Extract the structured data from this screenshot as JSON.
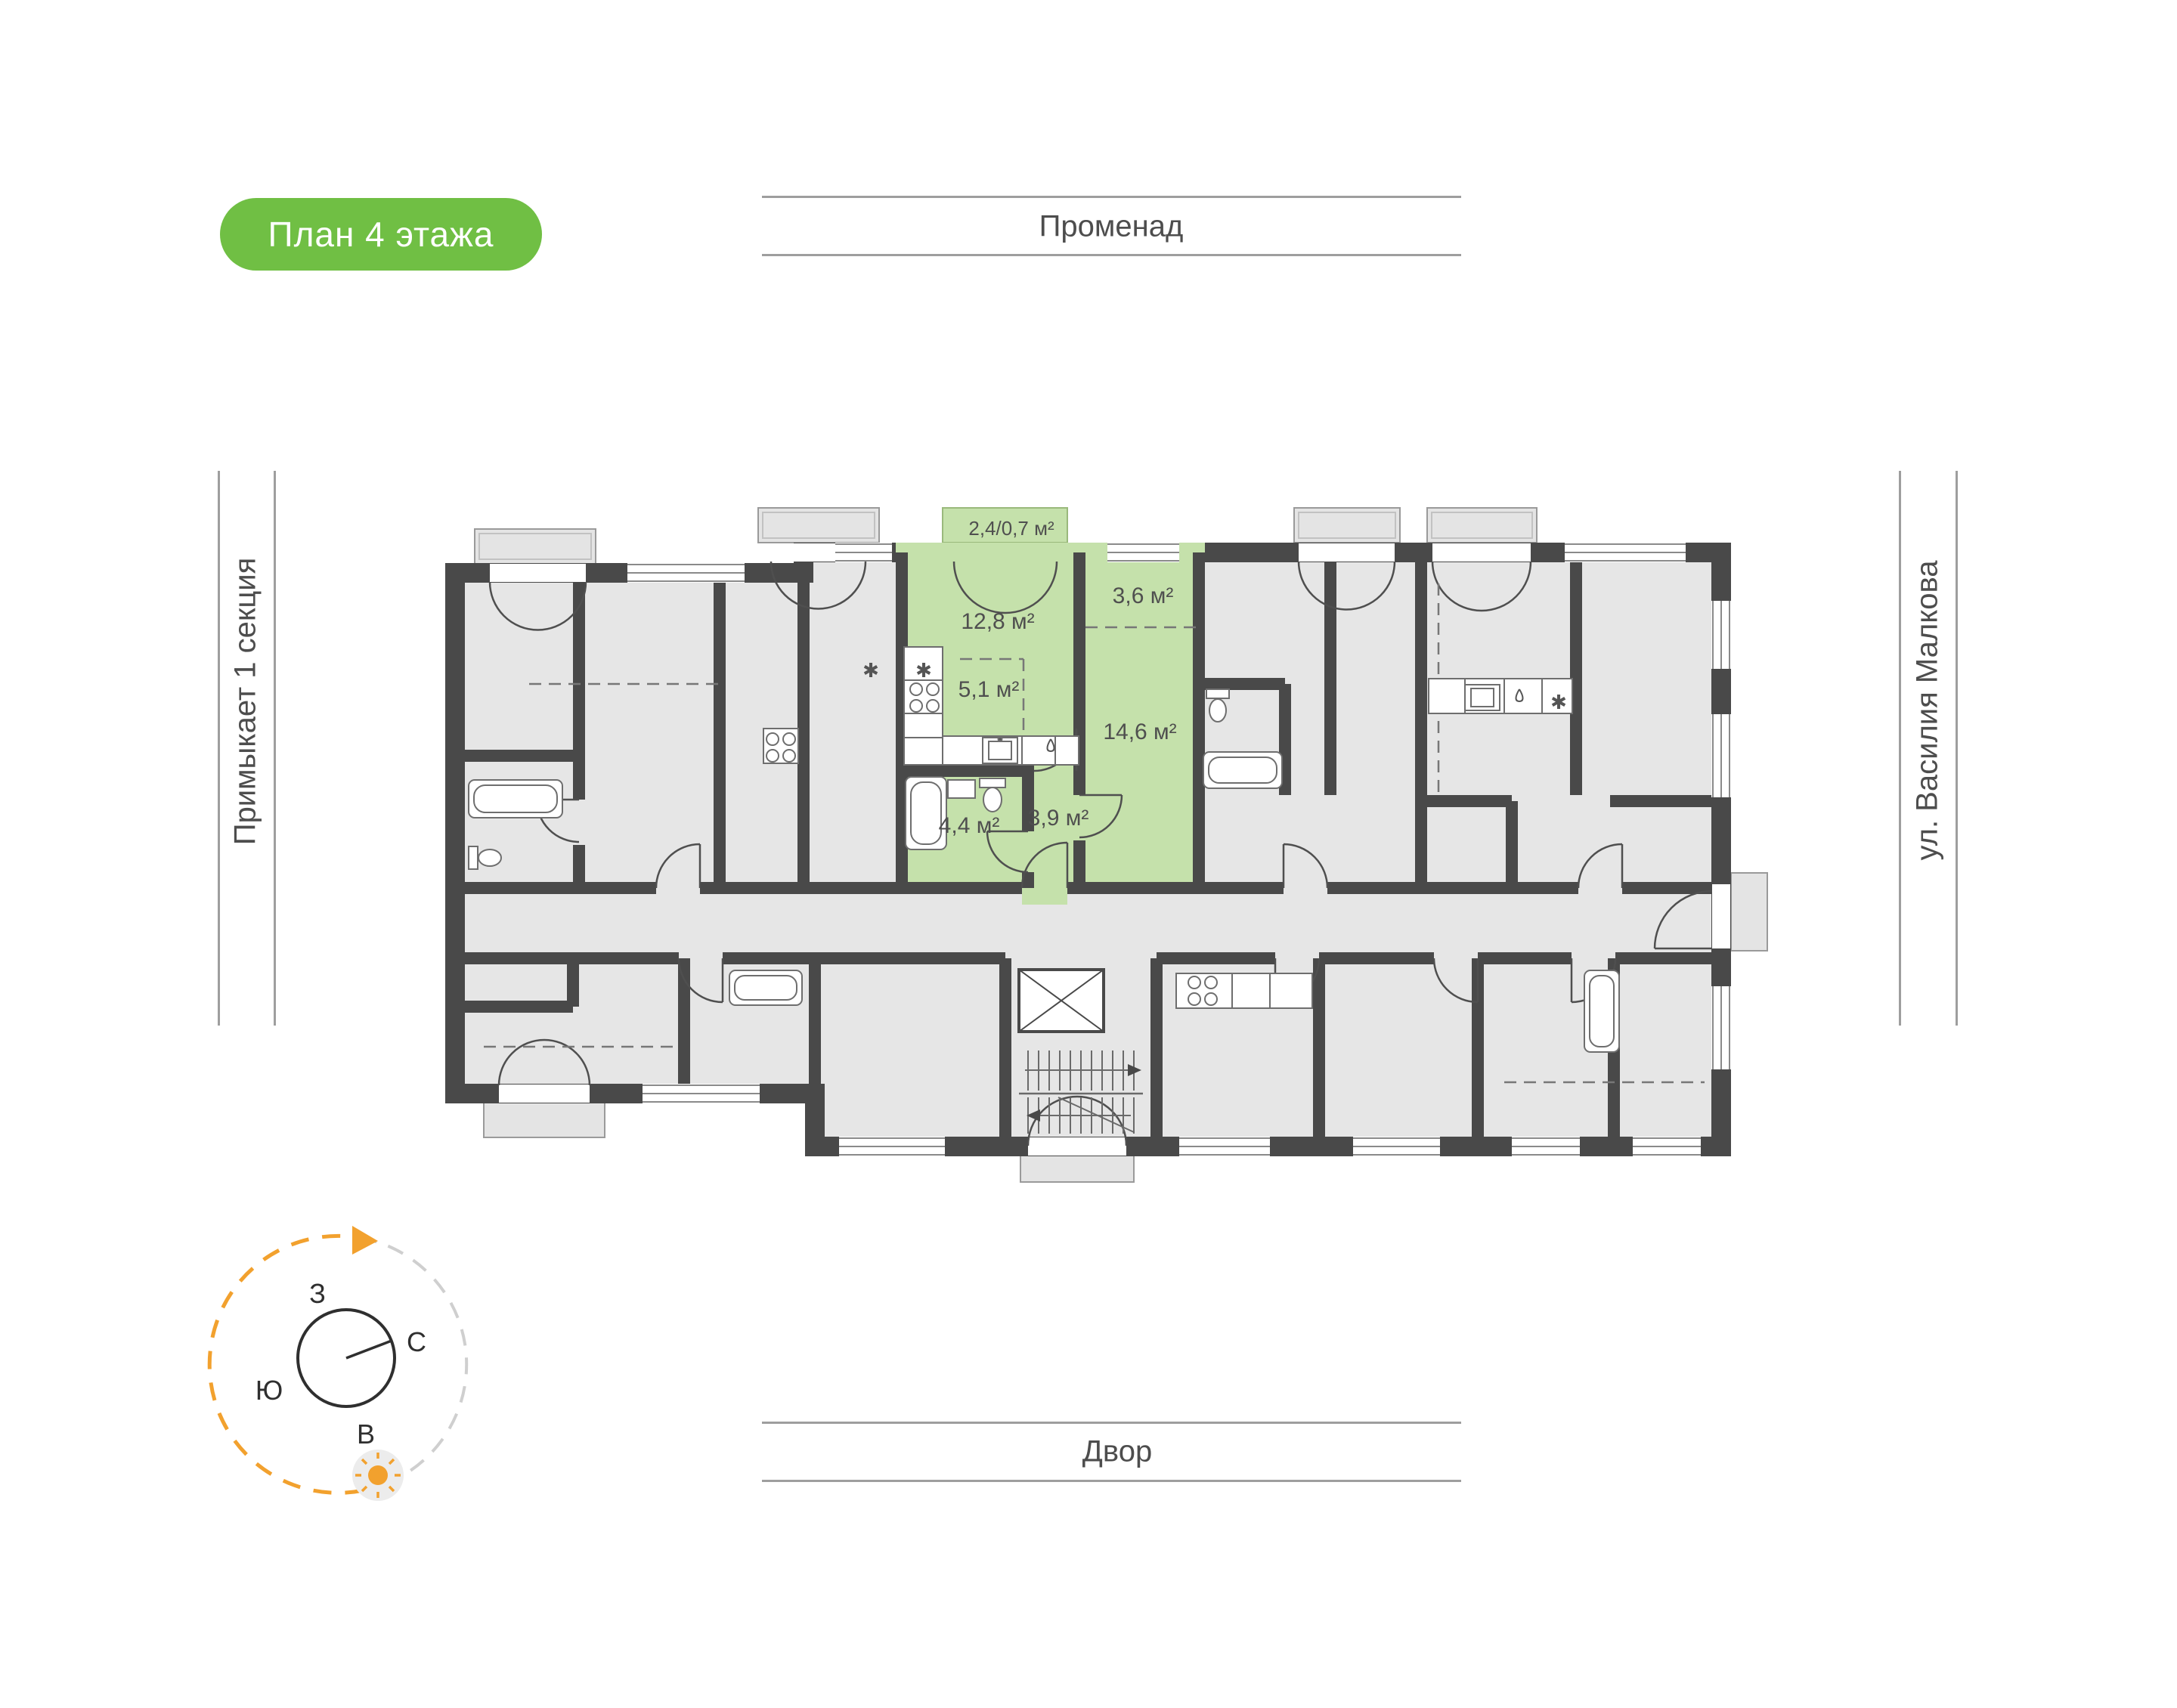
{
  "title_badge": {
    "label": "План 4 этажа",
    "background": "#70bf44",
    "text_color": "#ffffff"
  },
  "surroundings": {
    "top": "Променад",
    "bottom": "Двор",
    "left": "Примыкает 1 секция",
    "right": "ул. Василия Малкова"
  },
  "compass": {
    "west_label": "З",
    "north_label": "С",
    "south_label": "Ю",
    "east_label": "В",
    "accent_color": "#f2a12e"
  },
  "floor_plan": {
    "wall_color": "#494949",
    "room_fill": "#e6e6e6",
    "highlight_fill": "#c5e1ab",
    "highlighted_apartment": {
      "rooms": [
        {
          "name": "balcony",
          "area": "2,4/0,7 м²"
        },
        {
          "name": "kitchen-living-room",
          "area": "12,8 м²"
        },
        {
          "name": "dressing-area",
          "area": "3,6 м²"
        },
        {
          "name": "kitchen-area",
          "area": "5,1 м²"
        },
        {
          "name": "bedroom",
          "area": "14,6 м²"
        },
        {
          "name": "bathroom",
          "area": "4,4 м²"
        },
        {
          "name": "hallway",
          "area": "3,9 м²"
        }
      ]
    }
  }
}
